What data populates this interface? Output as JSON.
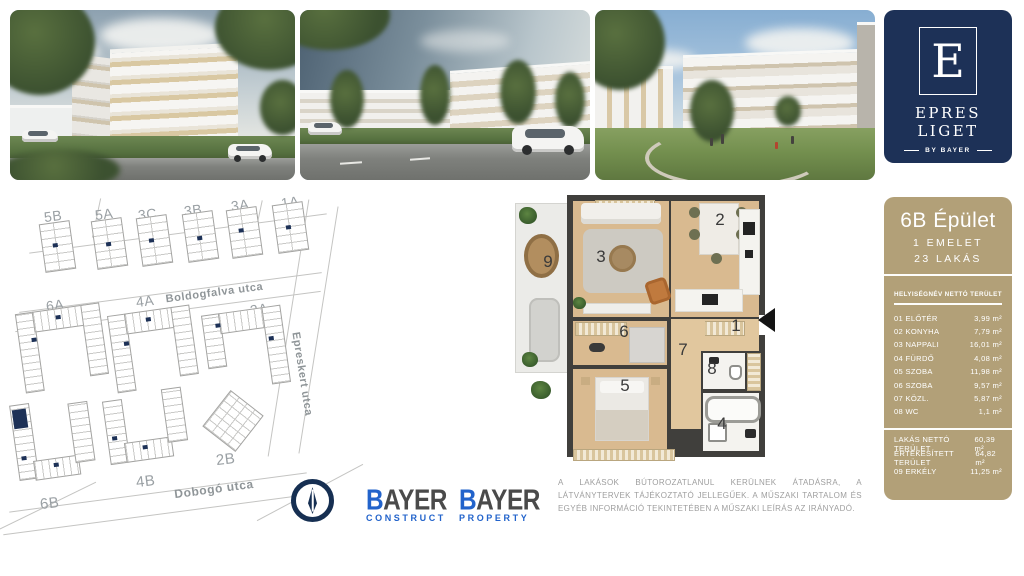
{
  "brand": {
    "logo_letter": "E",
    "name": "EPRES LIGET",
    "byline": "BY BAYER"
  },
  "panel": {
    "building": "6B Épület",
    "floor": "1 EMELET",
    "units": "23 LAKÁS",
    "columns": {
      "room": "HELYISÉGNÉV",
      "area": "NETTÓ TERÜLET"
    },
    "rooms": [
      {
        "label": "01 ELŐTÉR",
        "value": "3,99 m²"
      },
      {
        "label": "02 KONYHA",
        "value": "7,79 m²"
      },
      {
        "label": "03 NAPPALI",
        "value": "16,01 m²"
      },
      {
        "label": "04 FÜRDŐ",
        "value": "4,08 m²"
      },
      {
        "label": "05 SZOBA",
        "value": "11,98 m²"
      },
      {
        "label": "06 SZOBA",
        "value": "9,57 m²"
      },
      {
        "label": "07 KÖZL.",
        "value": "5,87 m²"
      },
      {
        "label": "08 WC",
        "value": "1,1 m²"
      }
    ],
    "totals": [
      {
        "label": "LAKÁS NETTÓ TERÜLET",
        "value": "60,39 m²"
      },
      {
        "label": "ÉRTÉKESÍTETT TERÜLET",
        "value": "64,82 m²"
      },
      {
        "label": "09 ERKÉLY",
        "value": "11,25 m²"
      }
    ]
  },
  "sitemap": {
    "blocks_row1": [
      "5B",
      "5A",
      "3C",
      "3B",
      "3A",
      "1A"
    ],
    "blocks_row2": [
      "6A",
      "4A",
      "2A"
    ],
    "blocks_row3": [
      "6B",
      "4B",
      "2B"
    ],
    "streets": {
      "top": "Boldogfalva utca",
      "right": "Epreskert utca",
      "bottom": "Dobogó utca"
    },
    "highlighted_building": "6B"
  },
  "floorplan": {
    "numbers": [
      "1",
      "2",
      "3",
      "4",
      "5",
      "6",
      "7",
      "8",
      "9"
    ]
  },
  "footer": {
    "logos": [
      {
        "initial": "B",
        "rest": "AYER",
        "sub": "CONSTRUCT"
      },
      {
        "initial": "B",
        "rest": "AYER",
        "sub": "PROPERTY"
      }
    ],
    "disclaimer": "A LAKÁSOK BÚTOROZATLANUL KERÜLNEK ÁTADÁSRA, A LÁTVÁNYTERVEK TÁJÉKOZTATÓ JELLEGŰEK. A MŰSZAKI TARTALOM ÉS EGYÉB INFORMÁCIÓ TEKINTETÉBEN A MŰSZAKI LEÍRÁS AZ IRÁNYADÓ."
  },
  "colors": {
    "navy": "#1d3157",
    "tan": "#b2a078",
    "logo_blue": "#2263cb"
  }
}
